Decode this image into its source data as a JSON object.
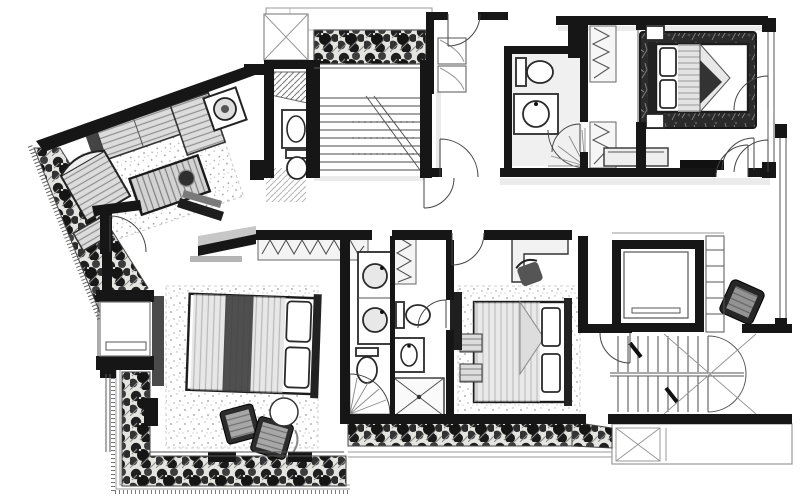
{
  "document": {
    "title": "Hand-drawn apartment floor plan, ink on white paper",
    "type": "architectural floor plan",
    "style": "black-and-white hand rendering with hatched planting and stippled rugs",
    "no_visible_text": true
  },
  "palette": {
    "paper": "#ffffff",
    "ink": "#161616",
    "wall_black": "#161616",
    "mid_gray": "#555555",
    "light_gray": "#b5b5b5",
    "foliage_dark": "#1e1e1e",
    "rug_dark": "#2b2b2b"
  },
  "rooms": [
    {
      "id": "living",
      "label": "Living room with angled exterior wall"
    },
    {
      "id": "entry",
      "label": "Entry hall"
    },
    {
      "id": "powder",
      "label": "Guest toilet under stair"
    },
    {
      "id": "stair-main",
      "label": "Main straight staircase with break line"
    },
    {
      "id": "void",
      "label": "Skylight void marked with X"
    },
    {
      "id": "terrace-top",
      "label": "Top terrace with planter strip"
    },
    {
      "id": "corridor-top",
      "label": "Upper corridor with cabinets"
    },
    {
      "id": "bath-top",
      "label": "Bathroom with corner shower"
    },
    {
      "id": "closet-corridor",
      "label": "Walk-in closet corridor"
    },
    {
      "id": "bedroom-1",
      "label": "Bedroom top right with dark rug"
    },
    {
      "id": "hallway",
      "label": "Hallway with bench"
    },
    {
      "id": "elevator",
      "label": "Elevator core"
    },
    {
      "id": "shaft",
      "label": "Service ladder shaft"
    },
    {
      "id": "stair-2",
      "label": "Secondary U-shaped staircase"
    },
    {
      "id": "terrace-br",
      "label": "Bottom right terrace with hatch panel"
    },
    {
      "id": "master",
      "label": "Master bedroom"
    },
    {
      "id": "master-bath",
      "label": "Master bathroom with double vanity"
    },
    {
      "id": "bath-center",
      "label": "Center bathroom with X shower tray"
    },
    {
      "id": "bedroom-2",
      "label": "Center bedroom with desk"
    },
    {
      "id": "planter-left",
      "label": "Triangular planter left"
    },
    {
      "id": "planter-bottom",
      "label": "L-shaped and bottom planters"
    },
    {
      "id": "bay",
      "label": "Bay window of master bedroom"
    }
  ],
  "furniture": {
    "living_room": [
      "sectional sofa",
      "chaise lounge",
      "side table with round lamp",
      "striped lounge armchair",
      "ottoman",
      "coffee table with bowl",
      "stippled area rug",
      "media wall with tv console"
    ],
    "master_bedroom": [
      "double bed with pillows",
      "dark throw band",
      "stippled rug",
      "zigzag wardrobe",
      "curtain panel",
      "bay window seat",
      "two dark lounge chairs",
      "round side table"
    ],
    "master_bathroom": [
      "double vanity with two round basins",
      "toilet",
      "shower with curved glass fan door"
    ],
    "center_bathroom": [
      "zigzag linen closet",
      "toilet",
      "oval basin counter",
      "square shower with X tray"
    ],
    "center_bedroom": [
      "double bed with pillows",
      "blanket fold",
      "desk",
      "desk chair",
      "dark dresser",
      "two striped stools",
      "stippled rug"
    ],
    "guest_toilet": [
      "counter with oval basin",
      "toilet",
      "hatched under-stair storage"
    ],
    "top_bathroom": [
      "toilet",
      "round basin counter",
      "corner fan shower"
    ],
    "walk_in_closet": [
      "three zigzag wardrobes"
    ],
    "bedroom_top_right": [
      "double bed",
      "headboard",
      "two nightstands",
      "two pillows",
      "folded dark blanket",
      "dark textured rug",
      "zigzag wardrobe",
      "two balcony door swings"
    ],
    "hallway": [
      "bench seat",
      "black console ledge",
      "dark armchair"
    ],
    "core": [
      "elevator cab",
      "ladder rung shaft"
    ]
  },
  "stairs": [
    {
      "id": "main",
      "label": "Straight flight, horizontal treads, diagonal break line, dotted nosings"
    },
    {
      "id": "secondary",
      "label": "Double flight U-stair, vertical treads, half-turn arc, crossed cut lines, two black direction ticks"
    }
  ],
  "planters": [
    {
      "id": "left",
      "label": "Dense foliage triangle along angled west edge"
    },
    {
      "id": "top",
      "label": "Rectangular planter over main stair terrace"
    },
    {
      "id": "bottom-left",
      "label": "L-shaped foliage band around master bedroom"
    },
    {
      "id": "bottom-center",
      "label": "Foliage strip along bottom of bedrooms"
    }
  ],
  "windows": [
    "east glazing of bedroom 1 with black jambs",
    "east glazing of hallway",
    "south glass wall of master bedroom with mullion blocks"
  ]
}
